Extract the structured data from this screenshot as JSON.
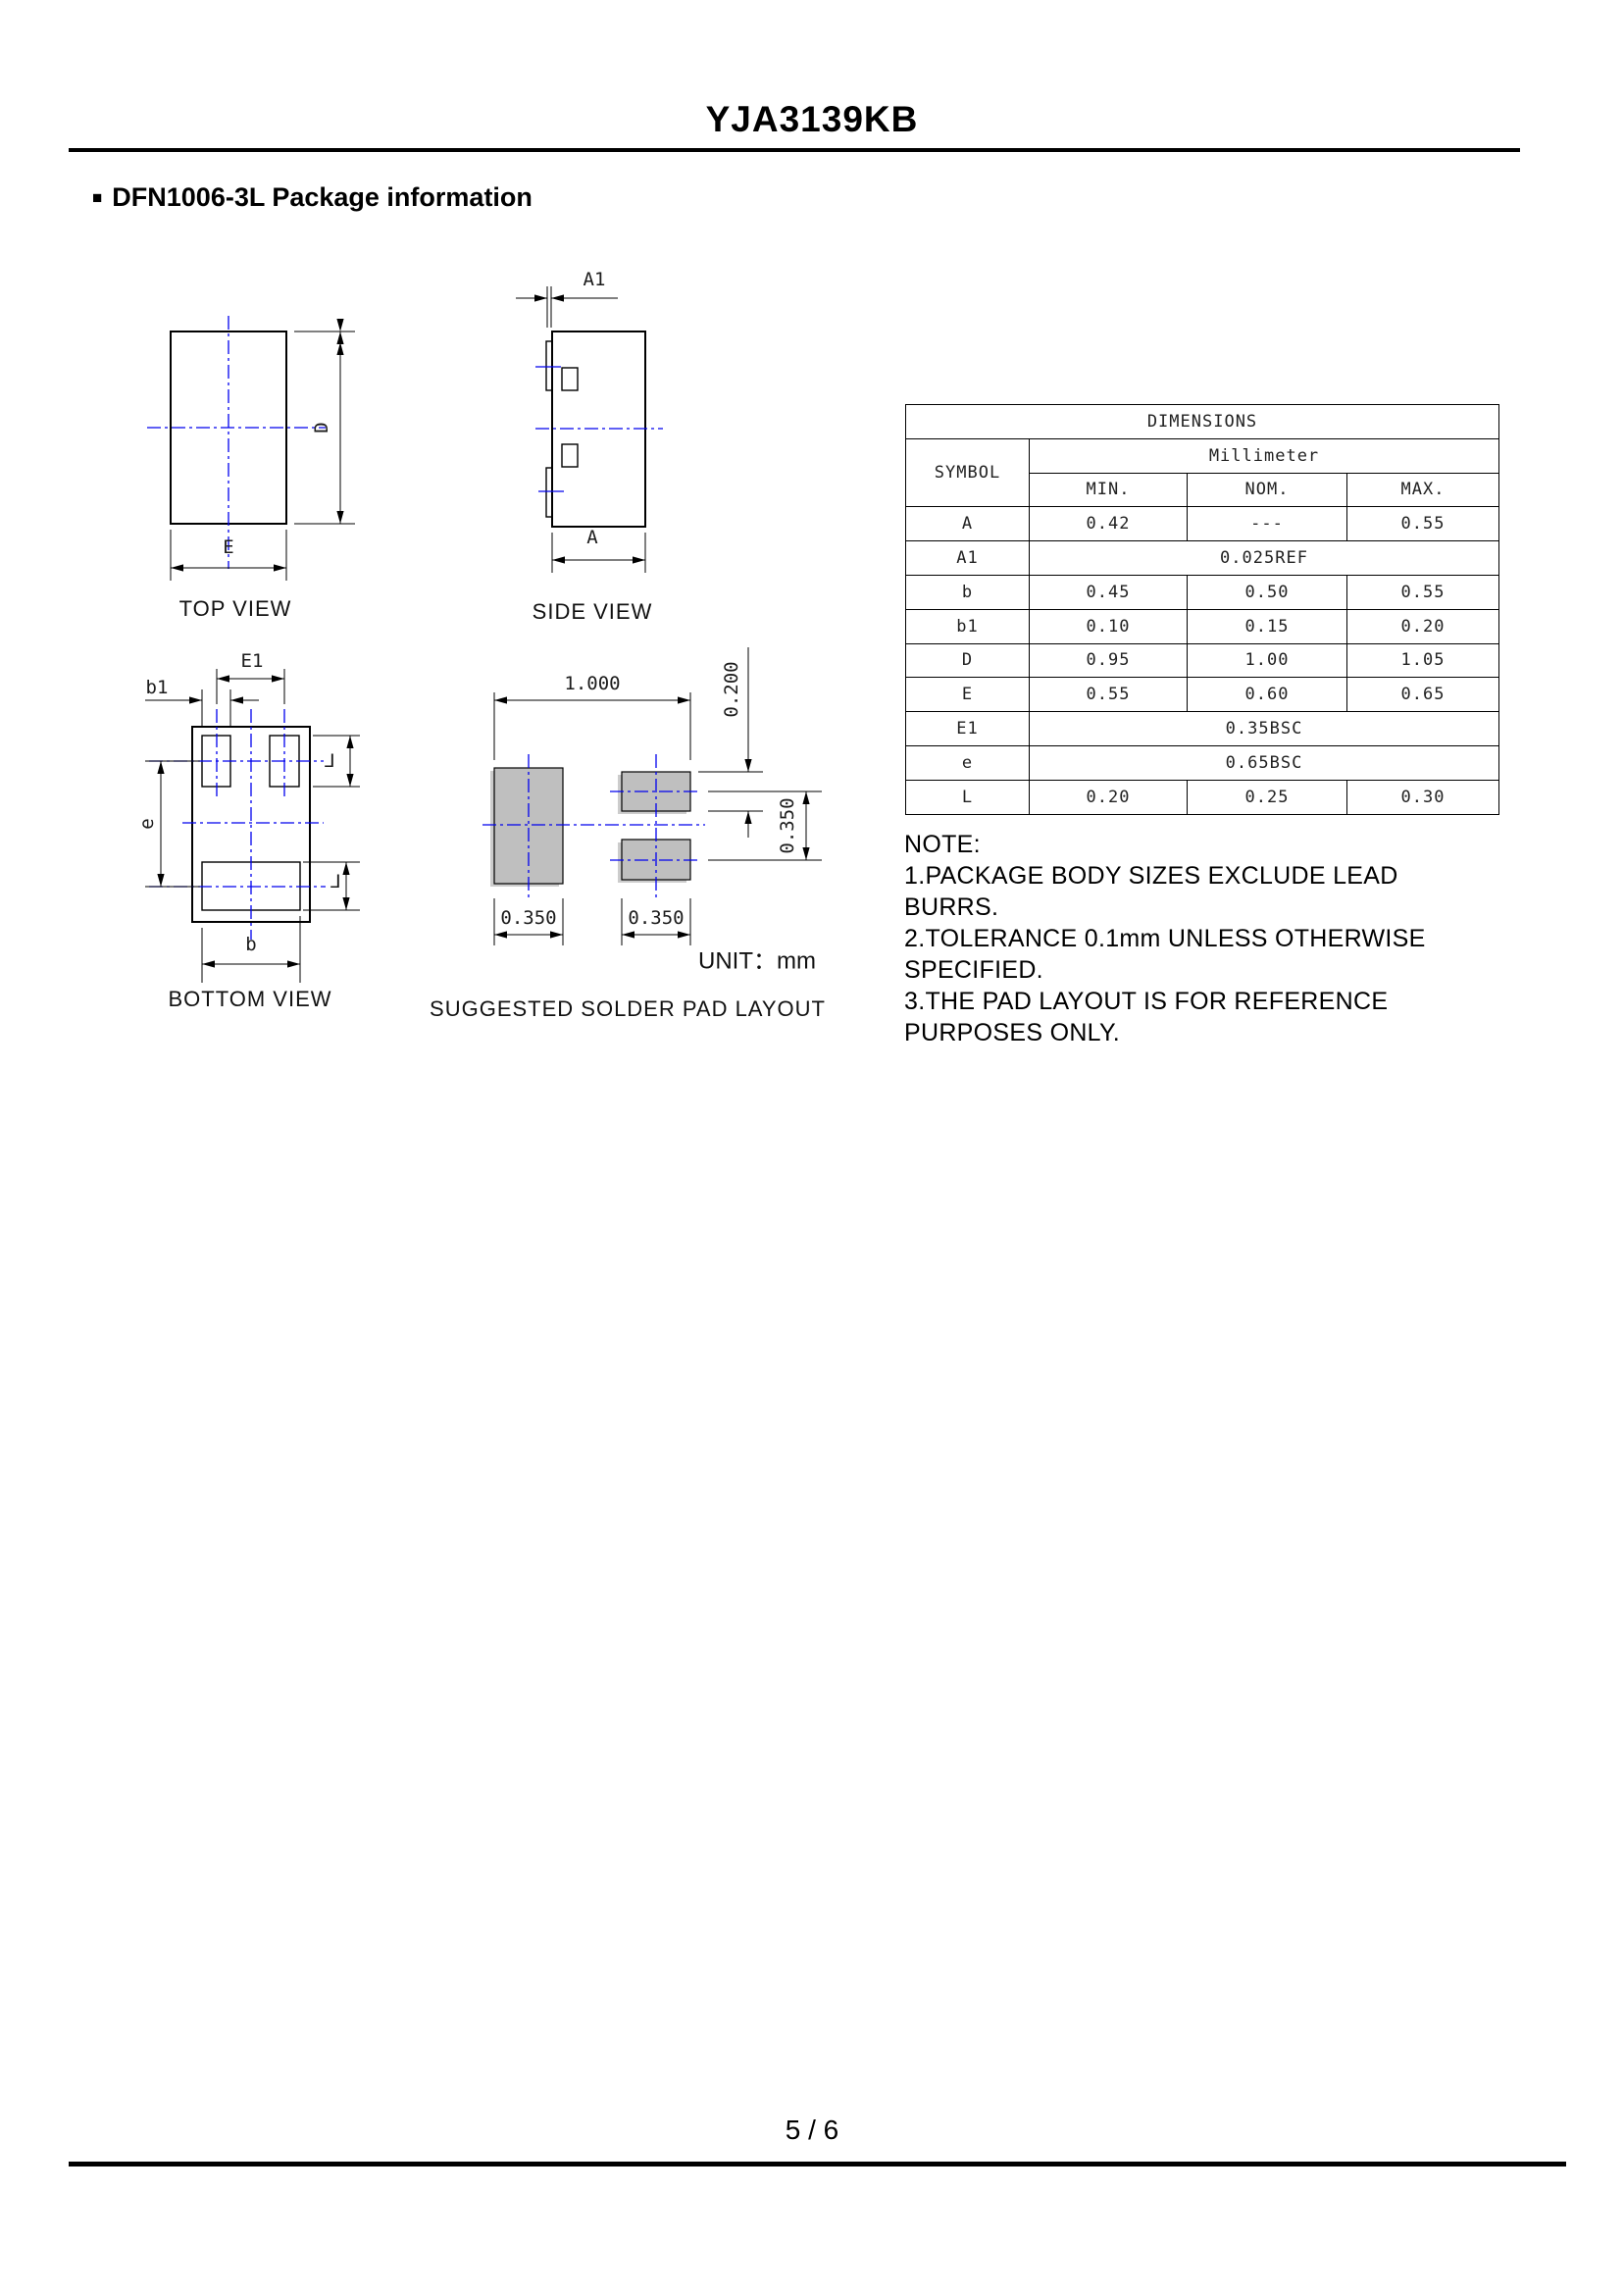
{
  "page": {
    "title": "YJA3139KB",
    "bullet": "■",
    "section_heading": "DFN1006-3L  Package information",
    "page_number": "5 / 6"
  },
  "diagrams": {
    "top_view": {
      "label": "TOP VIEW",
      "dim_d": "D",
      "dim_e": "E"
    },
    "side_view": {
      "label": "SIDE VIEW",
      "dim_a1": "A1",
      "dim_a": "A"
    },
    "bottom_view": {
      "label": "BOTTOM VIEW",
      "dim_e1": "E1",
      "dim_b1": "b1",
      "dim_e": "e",
      "dim_b": "b",
      "dim_l_top": "L",
      "dim_l_bottom": "L"
    },
    "pad_layout": {
      "label": "SUGGESTED SOLDER PAD LAYOUT",
      "unit_label": "UNIT：mm",
      "dim_total_width": "1.000",
      "dim_pad_height": "0.200",
      "dim_pitch": "0.350",
      "dim_left_pad_width": "0.350",
      "dim_right_pad_width": "0.350"
    }
  },
  "table": {
    "title": "DIMENSIONS",
    "symbol_header": "SYMBOL",
    "unit_header": "Millimeter",
    "col_headers": [
      "MIN.",
      "NOM.",
      "MAX."
    ],
    "rows": [
      {
        "symbol": "A",
        "min": "0.42",
        "nom": "---",
        "max": "0.55"
      },
      {
        "symbol": "A1",
        "span": "0.025REF"
      },
      {
        "symbol": "b",
        "min": "0.45",
        "nom": "0.50",
        "max": "0.55"
      },
      {
        "symbol": "b1",
        "min": "0.10",
        "nom": "0.15",
        "max": "0.20"
      },
      {
        "symbol": "D",
        "min": "0.95",
        "nom": "1.00",
        "max": "1.05"
      },
      {
        "symbol": "E",
        "min": "0.55",
        "nom": "0.60",
        "max": "0.65"
      },
      {
        "symbol": "E1",
        "span": "0.35BSC"
      },
      {
        "symbol": "e",
        "span": "0.65BSC"
      },
      {
        "symbol": "L",
        "min": "0.20",
        "nom": "0.25",
        "max": "0.30"
      }
    ]
  },
  "note": {
    "heading": "NOTE:",
    "lines": [
      "1.PACKAGE BODY SIZES EXCLUDE LEAD BURRS.",
      "2.TOLERANCE 0.1mm UNLESS OTHERWISE",
      "SPECIFIED.",
      "3.THE PAD LAYOUT IS FOR REFERENCE",
      "PURPOSES ONLY."
    ]
  },
  "colors": {
    "centerline_blue": "#0000ee",
    "line_black": "#000000",
    "pad_gray": "#bfbfbf",
    "pad_shadow_gray": "#cccccc"
  }
}
